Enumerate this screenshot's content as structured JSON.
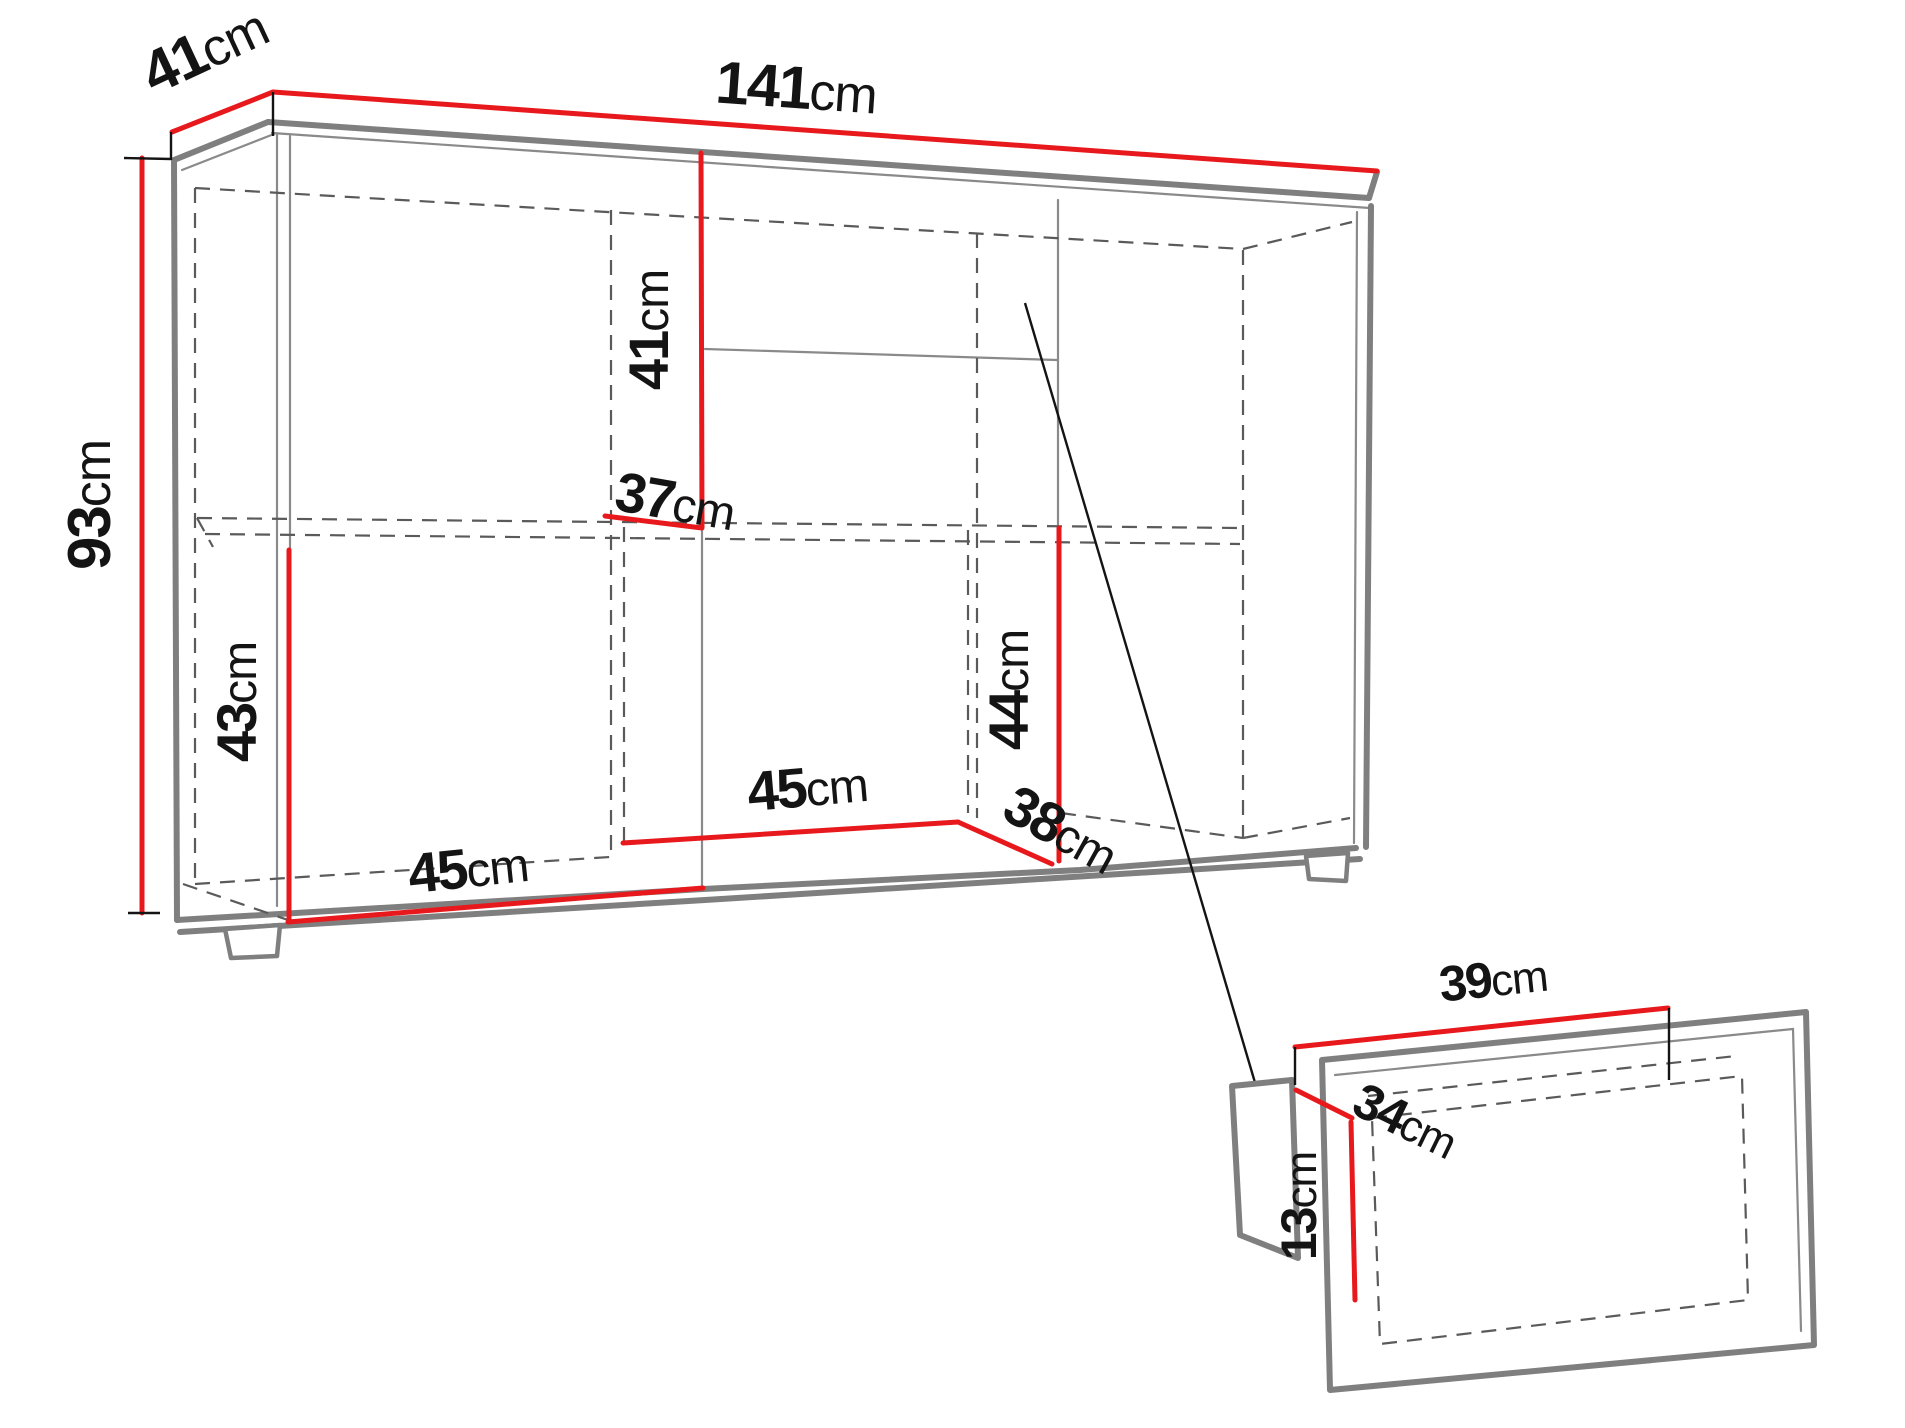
{
  "diagram": {
    "kind": "furniture-technical-dimension-drawing",
    "unit": "cm",
    "colors": {
      "dimension_line": "#e8191c",
      "cabinet_outline": "#7f7f7f",
      "hidden_line": "#5a5a5a",
      "text": "#141414",
      "background": "#ffffff"
    },
    "cabinet": {
      "overall_width": "141cm",
      "overall_depth": "41cm",
      "overall_height": "93cm"
    },
    "drawer": {
      "width": "39cm",
      "depth": "34cm",
      "height": "13cm"
    },
    "labels": [
      {
        "name": "top-depth",
        "value": "41",
        "unit": "cm"
      },
      {
        "name": "top-width",
        "value": "141",
        "unit": "cm"
      },
      {
        "name": "overall-height",
        "value": "93",
        "unit": "cm"
      },
      {
        "name": "upper-middle-inner-height",
        "value": "41",
        "unit": "cm"
      },
      {
        "name": "middle-inner-depth",
        "value": "37",
        "unit": "cm"
      },
      {
        "name": "lower-left-inner-height",
        "value": "43",
        "unit": "cm"
      },
      {
        "name": "lower-right-inner-height",
        "value": "44",
        "unit": "cm"
      },
      {
        "name": "bottom-left-inner-width",
        "value": "45",
        "unit": "cm"
      },
      {
        "name": "bottom-middle-inner-width",
        "value": "45",
        "unit": "cm"
      },
      {
        "name": "bottom-inner-depth",
        "value": "38",
        "unit": "cm"
      },
      {
        "name": "drawer-width",
        "value": "39",
        "unit": "cm"
      },
      {
        "name": "drawer-depth",
        "value": "34",
        "unit": "cm"
      },
      {
        "name": "drawer-height",
        "value": "13",
        "unit": "cm"
      }
    ]
  }
}
